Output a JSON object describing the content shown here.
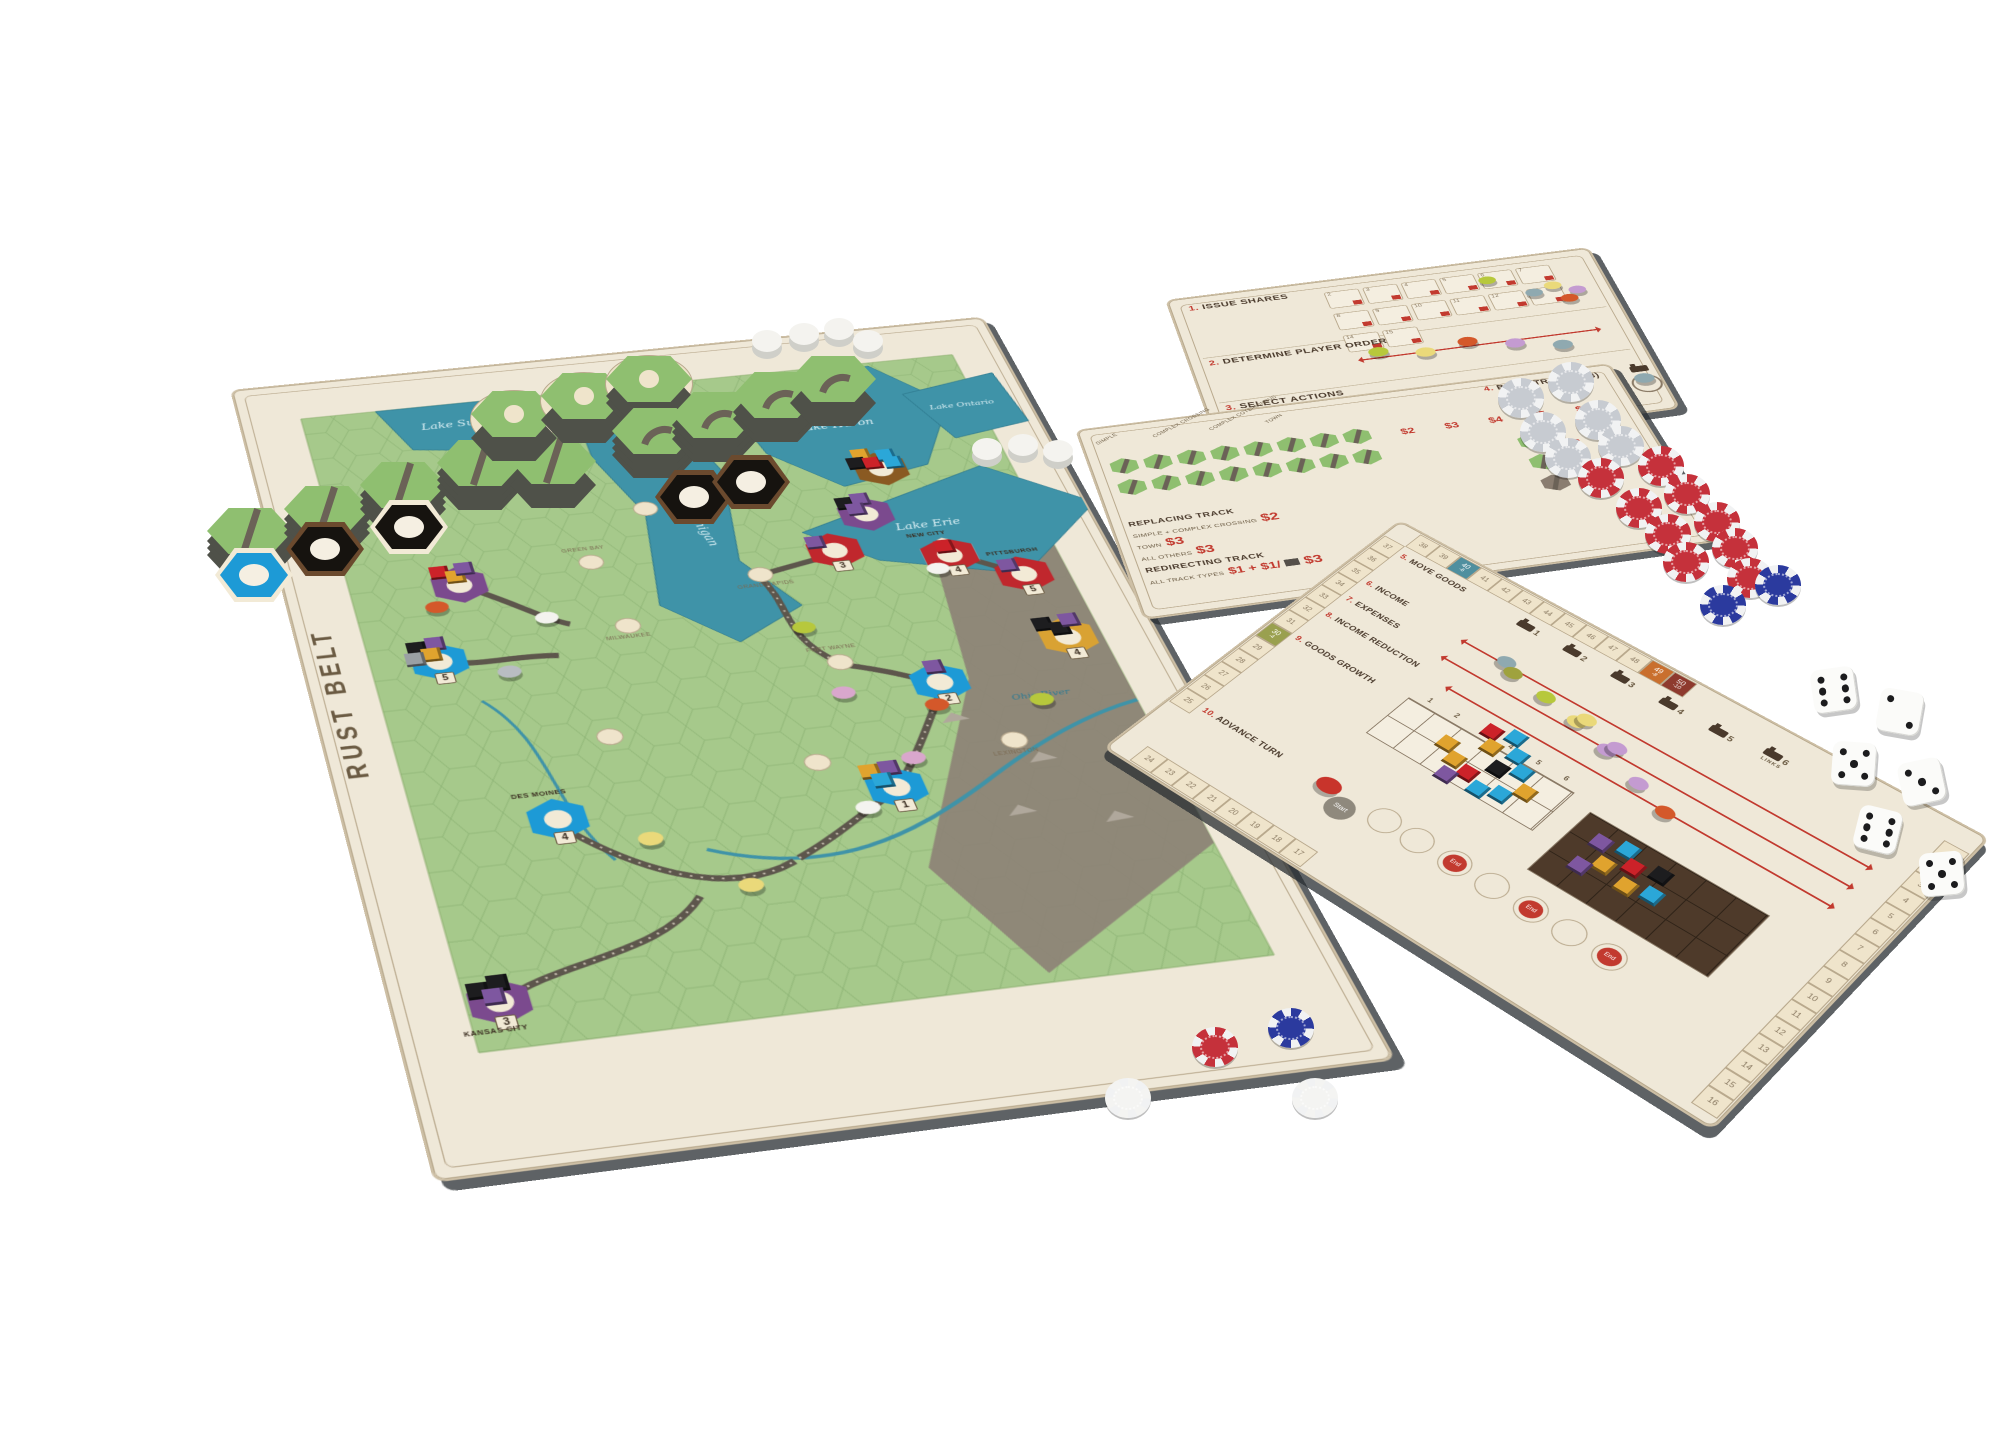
{
  "map_board": {
    "title": "RUST BELT",
    "lakes": [
      "Lake Superior",
      "Lake Michigan",
      "Lake Huron",
      "Lake Erie",
      "Lake Ontario"
    ],
    "river_label": "Ohio River",
    "cities": [
      {
        "name": "DES MOINES",
        "value": "4",
        "color": "blue",
        "cubes": []
      },
      {
        "name": "KANSAS CITY",
        "value": "3",
        "color": "purple",
        "cubes": [
          "black",
          "black",
          "purple"
        ]
      },
      {
        "name": "PITTSBURGH",
        "value": "5",
        "color": "red",
        "cubes": [
          "purple"
        ]
      },
      {
        "name": "NEW CITY",
        "letter": "A",
        "value": "4",
        "color": "red",
        "cubes": [
          "red"
        ]
      },
      {
        "name": "",
        "value": "3",
        "color": "red",
        "cubes": [
          "purple"
        ]
      },
      {
        "name": "",
        "value": "2",
        "color": "blue",
        "cubes": [
          "purple"
        ]
      },
      {
        "name": "",
        "value": "1",
        "color": "blue",
        "cubes": [
          "yellow",
          "purple",
          "blue"
        ]
      },
      {
        "name": "",
        "value": "5",
        "color": "blue",
        "cubes": [
          "black",
          "purple",
          "yellow",
          "gray"
        ]
      },
      {
        "name": "",
        "value": "",
        "color": "purple",
        "cubes": [
          "red",
          "yellow",
          "purple"
        ]
      },
      {
        "name": "",
        "value": "",
        "color": "brown",
        "cubes": [
          "yellow",
          "black",
          "red",
          "blue",
          "blue"
        ]
      },
      {
        "name": "",
        "value": "",
        "color": "purple",
        "cubes": [
          "black",
          "purple",
          "purple"
        ]
      },
      {
        "name": "",
        "value": "4",
        "color": "yellow",
        "cubes": [
          "black",
          "black",
          "purple"
        ]
      },
      {
        "name": "",
        "value": "",
        "color": "purple",
        "cubes": [
          "red",
          "purple",
          "yellow"
        ]
      }
    ],
    "towns": [
      "GREEN BAY",
      "MILWAUKEE",
      "GRAND RAPIDS",
      "FORT WAYNE",
      "LEXINGTON"
    ]
  },
  "player_aid_1": {
    "sections": [
      {
        "title_num": "1.",
        "title": "ISSUE SHARES",
        "share_label": "shares",
        "share_numbers": [
          "2",
          "3",
          "4",
          "5",
          "6",
          "7",
          "8",
          "9",
          "10",
          "11",
          "12",
          "13",
          "14",
          "15"
        ]
      },
      {
        "title_num": "2.",
        "title": "DETERMINE PLAYER ORDER"
      },
      {
        "title_num": "3.",
        "title": "SELECT ACTIONS"
      }
    ]
  },
  "player_aid_2": {
    "title_num": "4.",
    "title": "BUILD TRACK (0-3)",
    "column_headers": [
      "SIMPLE",
      "COMPLEX CROSSING",
      "COMPLEX COTERMINOUS",
      "TOWN"
    ],
    "build_costs": [
      "$2",
      "$3",
      "$4",
      "$5",
      "$6"
    ],
    "terrain_costs": [
      "$2",
      "$3",
      "$4"
    ],
    "replacing_track": {
      "title": "REPLACING TRACK",
      "rows": [
        {
          "label": "SIMPLE + COMPLEX CROSSING",
          "cost": "$2"
        },
        {
          "label": "TOWN",
          "cost": "$3"
        },
        {
          "label": "ALL OTHERS",
          "cost": "$3"
        }
      ]
    },
    "redirecting_track": {
      "title": "REDIRECTING TRACK",
      "label": "ALL TRACK TYPES",
      "cost": "$1 + $1/",
      "cost2": "$3"
    }
  },
  "score_board": {
    "phases": [
      {
        "num": "5.",
        "label": "MOVE GOODS"
      },
      {
        "num": "6.",
        "label": "INCOME"
      },
      {
        "num": "7.",
        "label": "EXPENSES"
      },
      {
        "num": "8.",
        "label": "INCOME REDUCTION"
      },
      {
        "num": "9.",
        "label": "GOODS GROWTH"
      },
      {
        "num": "10.",
        "label": "ADVANCE TURN"
      }
    ],
    "advance_turn": {
      "start": "Start",
      "end": "End"
    },
    "links_label": "LINKS",
    "links_numbers": [
      "1",
      "2",
      "3",
      "4",
      "5",
      "6"
    ],
    "goods_growth_columns": [
      "1",
      "2",
      "3",
      "4",
      "5",
      "6"
    ],
    "track_top": [
      "38",
      "39",
      {
        "label": "40",
        "note": "-6",
        "color": "teal"
      },
      "41",
      "42",
      "43",
      "44",
      "45",
      "46",
      "47",
      "48",
      {
        "label": "49",
        "note": "-8",
        "color": "orange"
      },
      {
        "label": "50",
        "note": "-10",
        "color": "maroon"
      }
    ],
    "track_left": [
      "37",
      "36",
      "35",
      "34",
      "33",
      "32",
      "31",
      {
        "label": "30",
        "note": "-4",
        "color": "olive"
      },
      "29",
      "28",
      "27",
      "26",
      "25"
    ],
    "track_right": [
      "1",
      "2",
      "3",
      "4",
      "5",
      "6",
      "7",
      "8",
      "9",
      "10",
      "11",
      "12",
      "13",
      "14",
      "15",
      "16"
    ],
    "track_bottom": [
      "24",
      "23",
      "22",
      "21",
      "20",
      "19",
      "18",
      "17"
    ]
  },
  "components": {
    "dice": [
      6,
      2,
      5,
      3,
      6,
      5
    ],
    "chips": {
      "white_stacks": 6,
      "red_stacks": 9,
      "blue_stacks": 2,
      "loose": [
        "red",
        "blue",
        "white",
        "white"
      ]
    },
    "new_city_tiles": [
      "B",
      "C",
      "D",
      "G",
      "H"
    ],
    "tile_stacks": {
      "straight": 5,
      "town": 3,
      "curve": 4
    },
    "disc_colors": [
      "lime",
      "yellow",
      "orange",
      "lilac",
      "teal",
      "white",
      "olive",
      "pink",
      "gray"
    ],
    "cube_colors": [
      "red",
      "yellow",
      "blue",
      "purple",
      "black",
      "gray"
    ]
  },
  "palette": {
    "board_beige": "#efe8d8",
    "map_green": "#a6c98b",
    "lake_teal": "#3f93a8",
    "hill_brown": "#8d8276",
    "accent_red": "#c23a2f",
    "city_red": "#c0272d",
    "city_blue": "#1d9ad6",
    "city_purple": "#7b4a8e",
    "chip_red": "#c5313b",
    "chip_blue": "#2b3a9e",
    "chip_white": "#c7cbd1"
  }
}
